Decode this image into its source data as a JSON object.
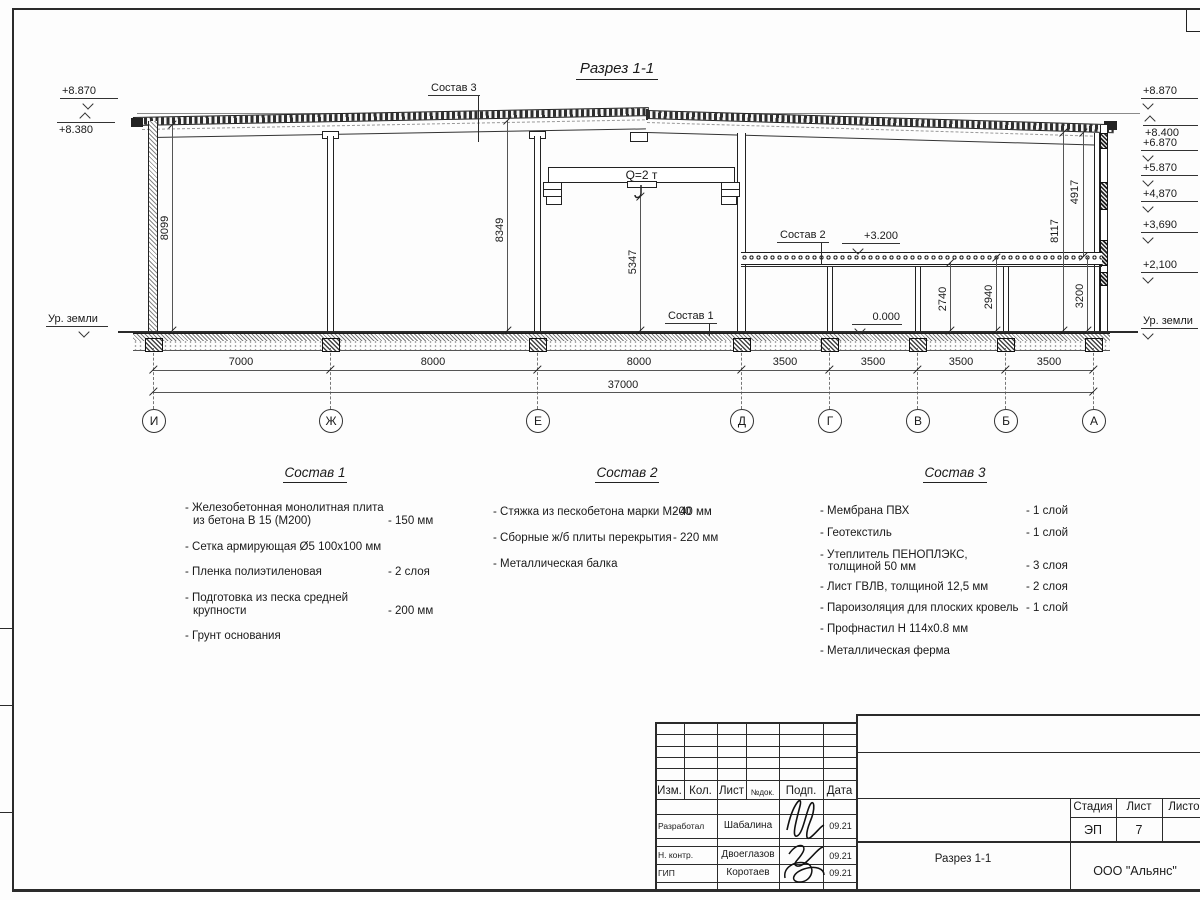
{
  "page": {
    "title": "Разрез 1-1"
  },
  "marks": {
    "left": [
      "+8.870",
      "+8.380",
      "Ур. земли"
    ],
    "right": [
      "+8.870",
      "+8.400",
      "+6.870",
      "+5.870",
      "+4,870",
      "+3,690",
      "+2,100",
      "Ур. земли"
    ]
  },
  "levels": {
    "l3200": "+3.200",
    "l0": "0.000"
  },
  "callouts": {
    "c1": "Состав 1",
    "c2": "Состав 2",
    "c3": "Состав 3"
  },
  "crane": {
    "label": "Q=2 т"
  },
  "vdims": {
    "d8099": "8099",
    "d8349": "8349",
    "d5347": "5347",
    "d4917": "4917",
    "d8117": "8117",
    "d2740": "2740",
    "d2940": "2940",
    "d3200": "3200"
  },
  "axes": [
    "И",
    "Ж",
    "Е",
    "Д",
    "Г",
    "В",
    "Б",
    "А"
  ],
  "spans": [
    "7000",
    "8000",
    "8000",
    "3500",
    "3500",
    "3500",
    "3500"
  ],
  "total": "37000",
  "sostav1": {
    "title": "Состав 1",
    "items": [
      {
        "text": "- Железобетонная  монолитная плита",
        "text2": "из бетона В 15 (М200)",
        "value": "- 150 мм"
      },
      {
        "text": "- Сетка армирующая Ø5 100х100 мм"
      },
      {
        "text": "- Пленка полиэтиленовая",
        "value": "-  2 слоя"
      },
      {
        "text": "- Подготовка из песка средней",
        "text2": "крупности",
        "value": "- 200 мм"
      },
      {
        "text": "- Грунт основания"
      }
    ]
  },
  "sostav2": {
    "title": "Состав 2",
    "items": [
      {
        "text": "- Стяжка из пескобетона марки М200",
        "value": "- 40 мм"
      },
      {
        "text": "- Сборные ж/б плиты перекрытия",
        "value": "- 220 мм"
      },
      {
        "text": "- Металлическая балка"
      }
    ]
  },
  "sostav3": {
    "title": "Состав 3",
    "items": [
      {
        "text": "- Мембрана ПВХ",
        "value": "- 1 слой"
      },
      {
        "text": "- Геотекстиль",
        "value": "- 1 слой"
      },
      {
        "text": "- Утеплитель ПЕНОПЛЭКС,",
        "text2": "толщиной 50 мм",
        "value": "- 3 слоя"
      },
      {
        "text": "- Лист ГВЛВ, толщиной 12,5 мм",
        "value": "- 2 слоя"
      },
      {
        "text": "- Пароизоляция для плоских кровель",
        "value": "- 1 слой"
      },
      {
        "text": "- Профнастил Н 114х0.8 мм"
      },
      {
        "text": "- Металлическая ферма"
      }
    ]
  },
  "titleblock": {
    "cols": [
      "Изм.",
      "Кол.",
      "Лист",
      "№док.",
      "Подп.",
      "Дата"
    ],
    "rows": [
      {
        "role": "Разработал",
        "name": "Шабалина",
        "date": "09.21"
      },
      {
        "role": "Н. контр.",
        "name": "Двоеглазов",
        "date": "09.21"
      },
      {
        "role": "ГИП",
        "name": "Коротаев",
        "date": "09.21"
      }
    ],
    "stage_cols": [
      "Стадия",
      "Лист",
      "Листов"
    ],
    "stage": "ЭП",
    "sheet": "7",
    "doc_title": "Разрез 1-1",
    "company": "ООО \"Альянс\""
  }
}
